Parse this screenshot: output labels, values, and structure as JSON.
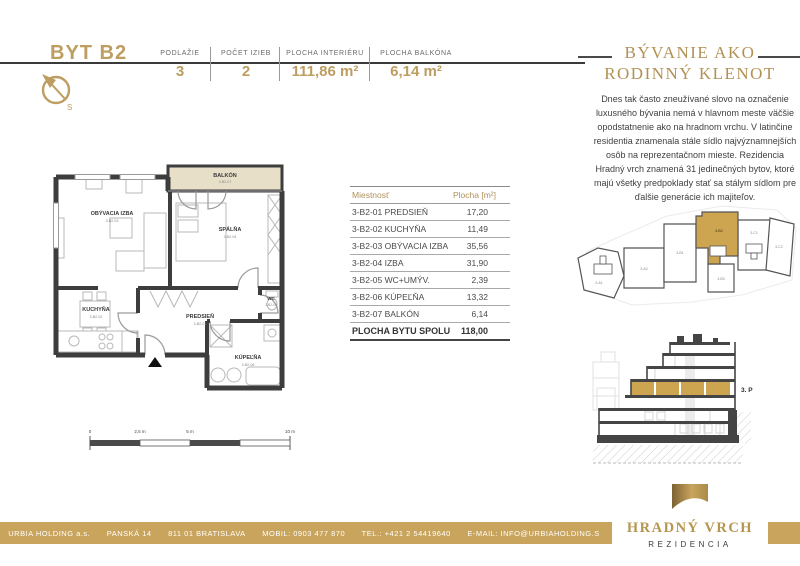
{
  "header": {
    "title": "BYT B2",
    "specs": [
      {
        "label": "PODLAŽIE",
        "value": "3"
      },
      {
        "label": "POČET IZIEB",
        "value": "2"
      },
      {
        "label": "PLOCHA INTERIÉRU",
        "value": "111,86 m²"
      },
      {
        "label": "PLOCHA BALKÓNA",
        "value": "6,14 m²"
      }
    ]
  },
  "sidebar": {
    "heading_line1": "BÝVANIE AKO",
    "heading_line2": "RODINNÝ KLENOT",
    "paragraph": "Dnes tak často zneužívané slovo na označenie luxusného bývania nemá v hlavnom meste väčšie opodstatnenie ako na hradnom vrchu. V latinčine residentia znamenala stále sídlo najvýznamnejších osôb na reprezentačnom mieste. Rezidencia Hradný vrch znamená 31 jedinečných bytov, ktoré majú všetky predpoklady stať sa stálym sídlom pre ďalšie generácie ich majiteľov."
  },
  "floorplan": {
    "rooms": [
      {
        "name": "OBÝVACIA IZBA",
        "code": "3-B2-03"
      },
      {
        "name": "SPÁLŇA",
        "code": "3-B2-04"
      },
      {
        "name": "KUCHYŇA",
        "code": "3-B2-02"
      },
      {
        "name": "PREDSIEŇ",
        "code": "3-B2-01"
      },
      {
        "name": "WC",
        "code": "3-B2-05"
      },
      {
        "name": "KÚPEĽŇA",
        "code": "3-B2-06"
      },
      {
        "name": "BALKÓN",
        "code": "3-B2-07"
      }
    ],
    "scale": [
      "0",
      "2,5 m",
      "5 m",
      "10 m"
    ],
    "compass_south": "S"
  },
  "room_table": {
    "headers": [
      "Miestnosť",
      "Plocha [m²]"
    ],
    "rows": [
      {
        "name": "3-B2-01 PREDSIEŇ",
        "area": "17,20"
      },
      {
        "name": "3-B2-02 KUCHYŇA",
        "area": "11,49"
      },
      {
        "name": "3-B2-03 OBÝVACIA IZBA",
        "area": "35,56"
      },
      {
        "name": "3-B2-04 IZBA",
        "area": "31,90"
      },
      {
        "name": "3-B2-05 WC+UMÝV.",
        "area": "2,39"
      },
      {
        "name": "3-B2-06 KÚPEĽŇA",
        "area": "13,32"
      },
      {
        "name": "3-B2-07 BALKÓN",
        "area": "6,14"
      }
    ],
    "total_label": "PLOCHA BYTU SPOLU",
    "total_value": "118,00"
  },
  "site_plan": {
    "units": [
      "3-A1",
      "3-A2",
      "3-B1",
      "3-B2",
      "3-B3",
      "3-C1",
      "3-C2"
    ],
    "highlighted": "3-B2"
  },
  "section": {
    "floor_label": "3. P"
  },
  "footer": {
    "items": [
      "URBIA HOLDING a.s.",
      "PANSKÁ 14",
      "811 01 BRATISLAVA",
      "MOBIL: 0903 477 870",
      "TEL.: +421 2 54419640",
      "E-MAIL: INFO@URBIAHOLDING.S"
    ],
    "logo": {
      "name": "HRADNÝ VRCH",
      "subtitle": "REZIDENCIA"
    }
  },
  "colors": {
    "accent_gold": "#bd9d60",
    "highlight_gold": "#cda44f",
    "balcony_beige": "#e7dfc8",
    "footer_gold": "#c9a45c",
    "wall_dark": "#3d3d3d"
  }
}
